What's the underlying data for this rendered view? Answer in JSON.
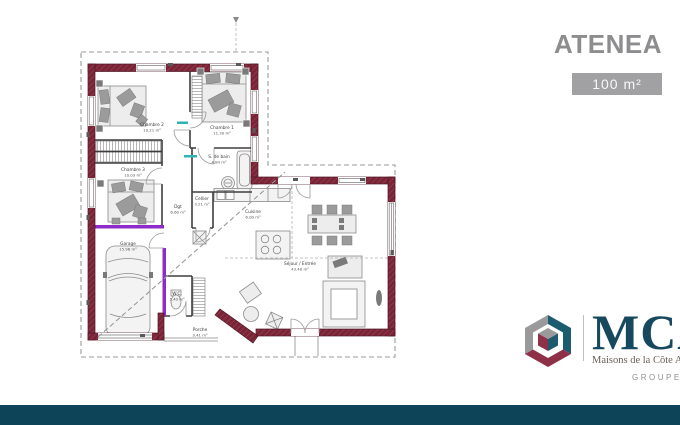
{
  "header": {
    "title": "ATENEA",
    "area_badge": "100 m²"
  },
  "plan": {
    "rooms": [
      {
        "name": "Chambre 2",
        "area": "10.21 m²"
      },
      {
        "name": "Chambre 1",
        "area": "11.30 m²"
      },
      {
        "name": "Chambre 3",
        "area": "10.03 m²"
      },
      {
        "name": "S. de bain",
        "area": "4.84 m²"
      },
      {
        "name": "Dgt",
        "area": "6.60 m²"
      },
      {
        "name": "Cellier",
        "area": "3.21 m²"
      },
      {
        "name": "Cuisine",
        "area": "6.00 m²"
      },
      {
        "name": "Séjour / Entrée",
        "area": "43.40 m²"
      },
      {
        "name": "Garage",
        "area": "15.96 m²"
      },
      {
        "name": "W.C.",
        "area": "1.40 m²"
      },
      {
        "name": "Porche",
        "area": "3.41 m²"
      }
    ]
  },
  "logo": {
    "brand": "MCA",
    "tagline": "Maisons de la Côte Atlantique",
    "group": "GROUPE HEXAOM"
  },
  "colors": {
    "wall": "#7a2437",
    "purple": "#8d2cc9",
    "teal": "#2fb3b6",
    "brand_navy": "#17495e",
    "cube_teal": "#1d5c6e",
    "logo_maroon": "#8e3048",
    "logo_gray": "#9a9a9c",
    "footer": "#0e4458",
    "title": "#8d8d8f",
    "badge": "#a1a1a4",
    "tagline": "#6b5e55",
    "group_gray": "#909090"
  }
}
